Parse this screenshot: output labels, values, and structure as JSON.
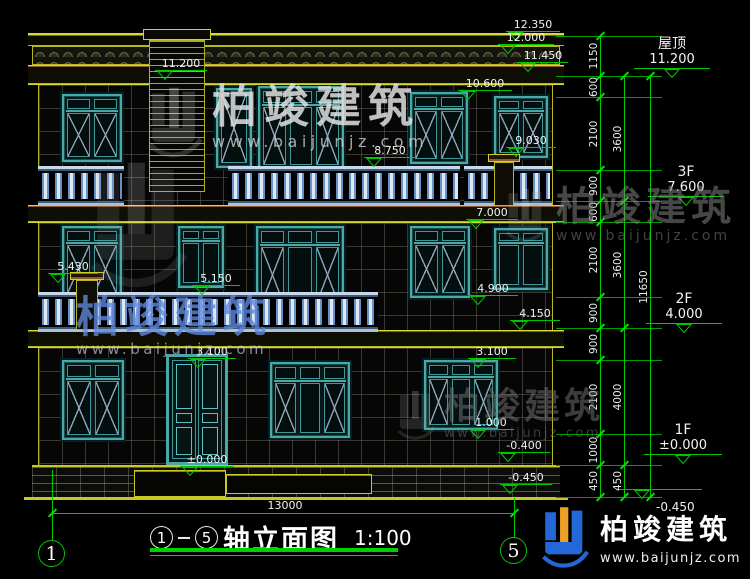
{
  "drawing": {
    "title_axis_start": "1",
    "title_axis_end": "5",
    "title_text": "轴立面图",
    "title_scale": "1:100",
    "bottom_dimension": "13000",
    "grid_bubble_left": "1",
    "grid_bubble_right": "5"
  },
  "floor_labels": [
    {
      "name": "屋顶",
      "level": "11.200"
    },
    {
      "name": "3F",
      "level": "7.600"
    },
    {
      "name": "2F",
      "level": "4.000"
    },
    {
      "name": "1F",
      "level": "±0.000"
    },
    {
      "name": "",
      "level": "-0.450"
    }
  ],
  "elevation_markers": [
    "12.350",
    "12.000",
    "11.450",
    "11.200",
    "10.600",
    "9.030",
    "8.750",
    "7.000",
    "5.430",
    "5.150",
    "4.900",
    "4.150",
    "3.100",
    "3.100",
    "1.000",
    "±0.000",
    "-0.400",
    "-0.450"
  ],
  "dim_chain_inner": [
    "1150",
    "600",
    "2100",
    "900",
    "600",
    "2100",
    "900",
    "900",
    "2100",
    "1000",
    "450"
  ],
  "dim_chain_mid": [
    "3600",
    "3600",
    "4000",
    "450"
  ],
  "dim_chain_outer": [
    "11650"
  ],
  "watermark": {
    "brand": "柏竣建筑",
    "site": "www.baijunjz.com"
  },
  "colors": {
    "dim_green": "#00c800",
    "line_yellow": "#b8b81c",
    "window_teal": "#4aa8a8",
    "baluster_blue": "#6a90c8",
    "logo_blue": "#2468d8",
    "logo_orange": "#f0a028"
  }
}
